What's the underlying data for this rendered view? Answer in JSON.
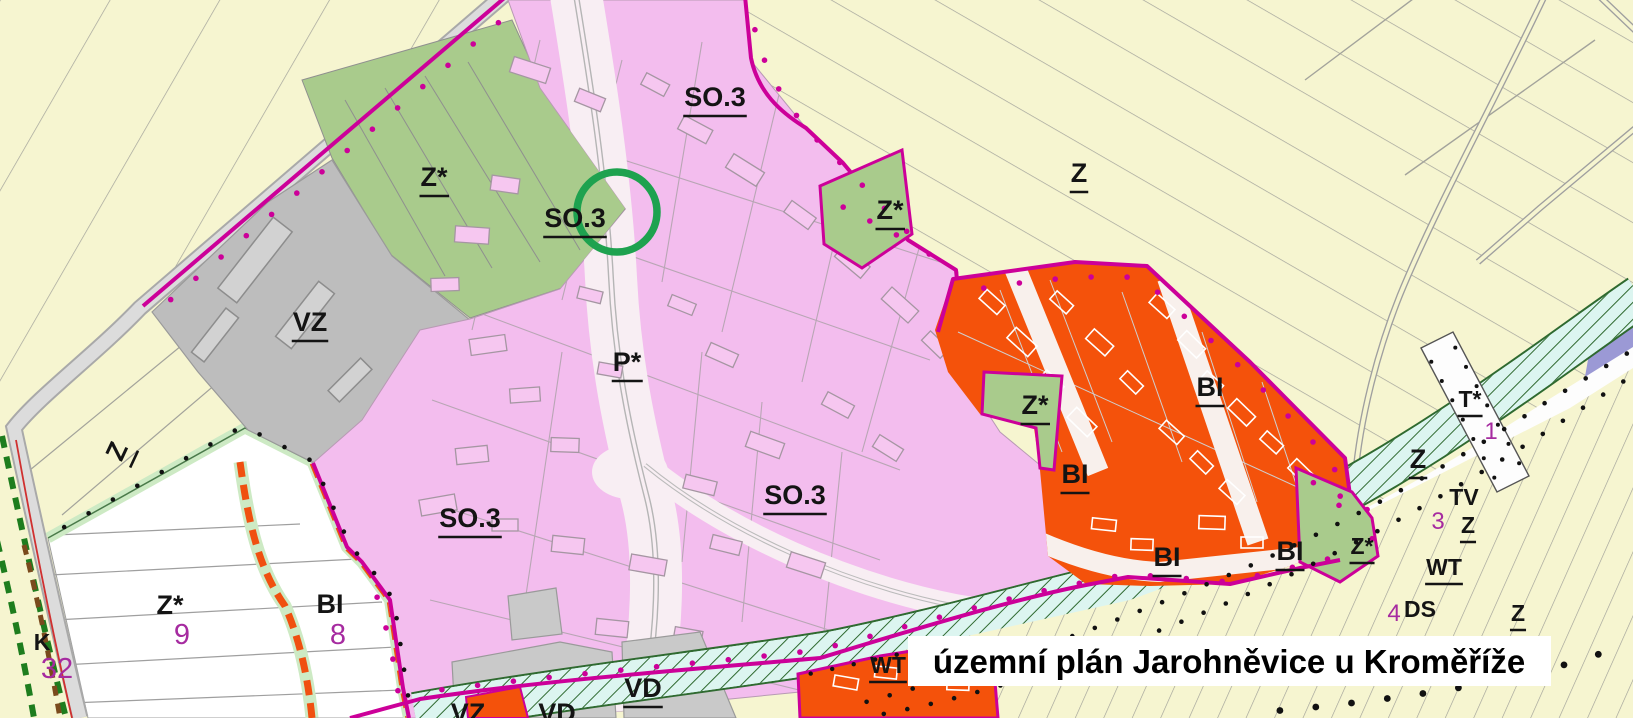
{
  "title": {
    "text": "územní plán Jarohněvice u Kroměříže"
  },
  "annotation": {
    "shape": "circle",
    "color": "#1ea24f",
    "meaning": "highlight-marker"
  },
  "map": {
    "zone_colors": {
      "so3_mixed_residential": "#f3bdee",
      "bi_housing_proposed": "#f4520b",
      "z_star_greenery": "#a9cb8c",
      "vz_vd_production": "#bdbdbd",
      "wt_watercourse": "#dcf5f0",
      "fields_background": "#f6f5d0",
      "ds_transport_corridor": "#ffffff",
      "tx_corridor_purple": "#9b99d5",
      "boundary_magenta": "#cc0099",
      "label_number_magenta": "#a62ba0"
    },
    "labels": [
      {
        "id": "so3-north",
        "text": "SO.3"
      },
      {
        "id": "zstar-nw",
        "text": "Z*"
      },
      {
        "id": "so3-circled",
        "text": "SO.3"
      },
      {
        "id": "zstar-mid",
        "text": "Z*"
      },
      {
        "id": "z-ne",
        "text": "Z"
      },
      {
        "id": "vz",
        "text": "VZ"
      },
      {
        "id": "pstar",
        "text": "P*"
      },
      {
        "id": "z-west",
        "text": "Z"
      },
      {
        "id": "zstar-wedge",
        "text": "Z*"
      },
      {
        "id": "bi-ne",
        "text": "BI"
      },
      {
        "id": "bi-mid",
        "text": "BI"
      },
      {
        "id": "so3-sw",
        "text": "SO.3"
      },
      {
        "id": "so3-se",
        "text": "SO.3"
      },
      {
        "id": "z-east",
        "text": "Z"
      },
      {
        "id": "tstar",
        "text": "T*"
      },
      {
        "id": "num-1",
        "text": "1"
      },
      {
        "id": "tv",
        "text": "TV"
      },
      {
        "id": "num-3",
        "text": "3"
      },
      {
        "id": "z-tv",
        "text": "Z"
      },
      {
        "id": "wt-east",
        "text": "WT"
      },
      {
        "id": "ds",
        "text": "DS"
      },
      {
        "id": "num-4",
        "text": "4"
      },
      {
        "id": "z-se",
        "text": "Z"
      },
      {
        "id": "zstar-east",
        "text": "Z*"
      },
      {
        "id": "bi-s1",
        "text": "BI"
      },
      {
        "id": "bi-s2",
        "text": "BI"
      },
      {
        "id": "wt-south",
        "text": "WT"
      },
      {
        "id": "vd",
        "text": "VD"
      },
      {
        "id": "vd-cut",
        "text": "VD"
      },
      {
        "id": "vz-cut",
        "text": "VZ"
      },
      {
        "id": "zstar-white",
        "text": "Z*"
      },
      {
        "id": "num-9",
        "text": "9"
      },
      {
        "id": "bi-white",
        "text": "BI"
      },
      {
        "id": "num-8",
        "text": "8"
      },
      {
        "id": "k",
        "text": "K"
      },
      {
        "id": "num-32",
        "text": "32"
      }
    ]
  }
}
